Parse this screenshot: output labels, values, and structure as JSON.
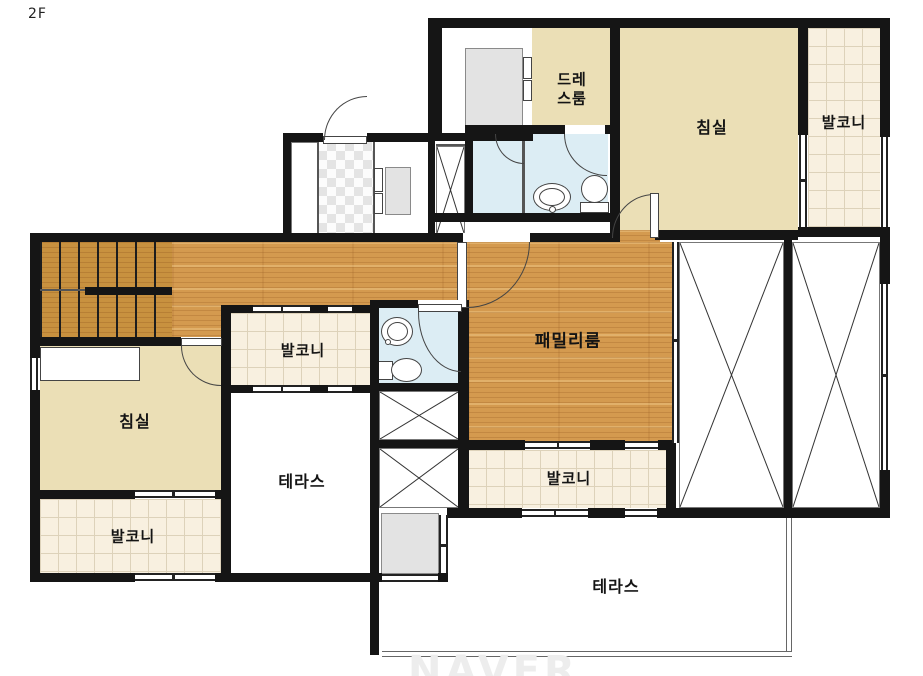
{
  "floor_label": "2F",
  "watermark": "NAVER",
  "labels": {
    "dress_room_line1": "드레",
    "dress_room_line2": "스룸",
    "bedroom_top": "침실",
    "balcony_top_right": "발코니",
    "family_room": "패밀리룸",
    "balcony_mid": "발코니",
    "terrace_left": "테라스",
    "bedroom_left": "침실",
    "balcony_bottom_left": "발코니",
    "balcony_bottom_mid": "발코니",
    "terrace_bottom": "테라스"
  },
  "legend_colors": {
    "wall": "#151515",
    "wood_floor": "#d49a4f",
    "stair_wood": "#c8913f",
    "room_cream": "#ebdfb6",
    "balcony_tile": "#f8f0e0",
    "bathroom_blue": "#dcedf4",
    "fixture_gray": "#e3e3e3"
  }
}
